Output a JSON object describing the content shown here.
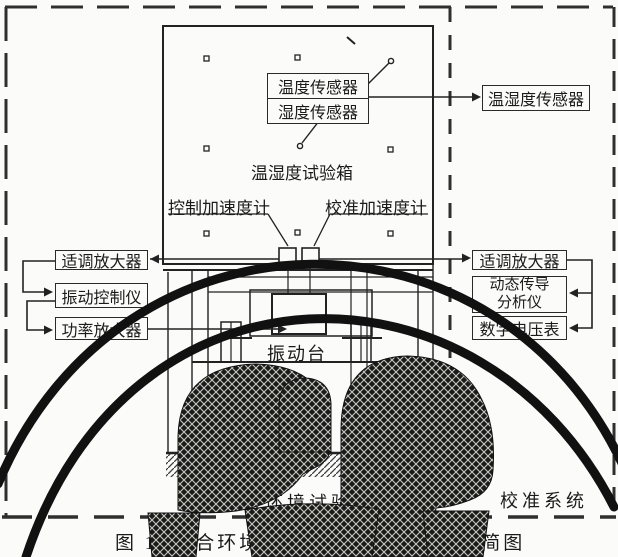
{
  "figure": {
    "chamber": {
      "name": "温湿度试验箱",
      "temperature_sensor": "温度传感器",
      "humidity_sensor": "湿度传感器",
      "control_accelerometer": "控制加速度计",
      "calibration_accelerometer": "校准加速度计"
    },
    "test_side": {
      "conditioning_amplifier": "适调放大器",
      "vibration_controller": "振动控制仪",
      "power_amplifier": "功率放大器",
      "shaker": "振动台",
      "system_label": "综合环境试验系统"
    },
    "calibration_side": {
      "temp_humidity_sensor": "温湿度传感器",
      "conditioning_amplifier": "适调放大器",
      "dynamic_analyzer_line1": "动态传导",
      "dynamic_analyzer_line2": "分析仪",
      "digital_voltmeter": "数字电压表",
      "system_label": "校准系统"
    },
    "caption": {
      "figure_no": "图 1",
      "title": "综合环境试验系统及其校准系统简图"
    }
  },
  "colors": {
    "ink": "#222222",
    "paper": "#fbfbfa",
    "arc": "#111111"
  }
}
